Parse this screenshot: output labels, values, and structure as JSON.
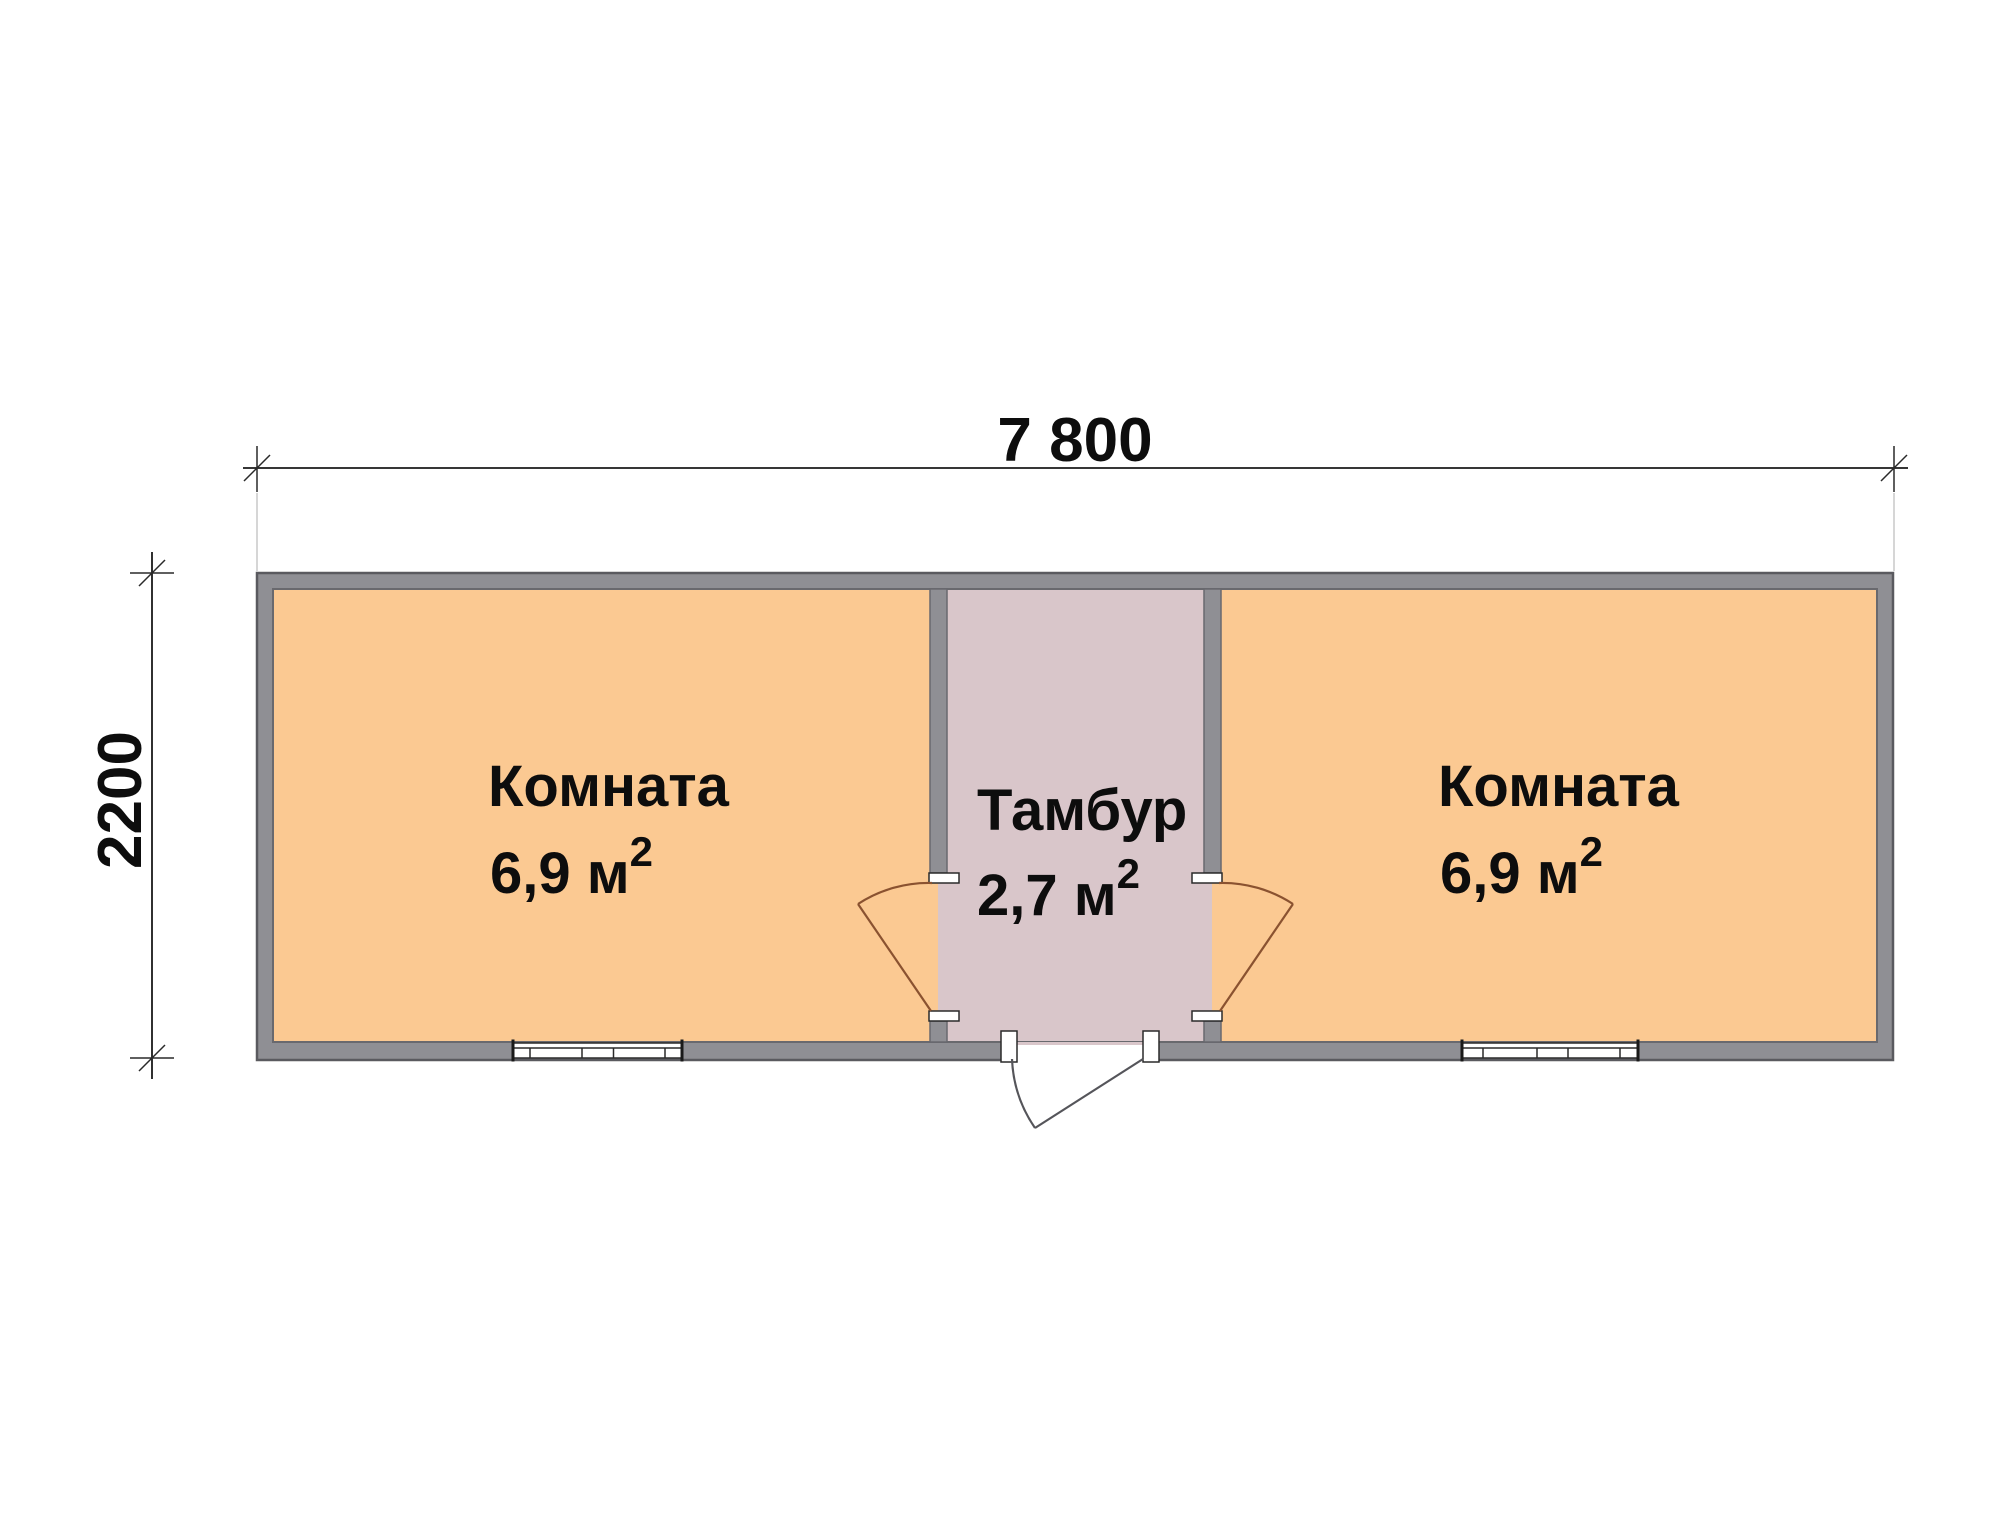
{
  "dimensions": {
    "width_label": "7 800",
    "height_label": "2200"
  },
  "rooms": [
    {
      "name": "Комната",
      "area": "6,9 м",
      "area_sup": "2"
    },
    {
      "name": "Тамбур",
      "area": "2,7 м",
      "area_sup": "2"
    },
    {
      "name": "Комната",
      "area": "6,9 м",
      "area_sup": "2"
    }
  ],
  "colors": {
    "room_fill": "#fbc992",
    "vestibule_fill": "#d9c6ca",
    "wall_fill": "#8f8f94",
    "wall_outline": "#69696e",
    "outer_outline": "#5a5a5f",
    "interior_door": "#8a5230",
    "exterior_door": "#55555a",
    "dimension": "#1a1a1a"
  }
}
